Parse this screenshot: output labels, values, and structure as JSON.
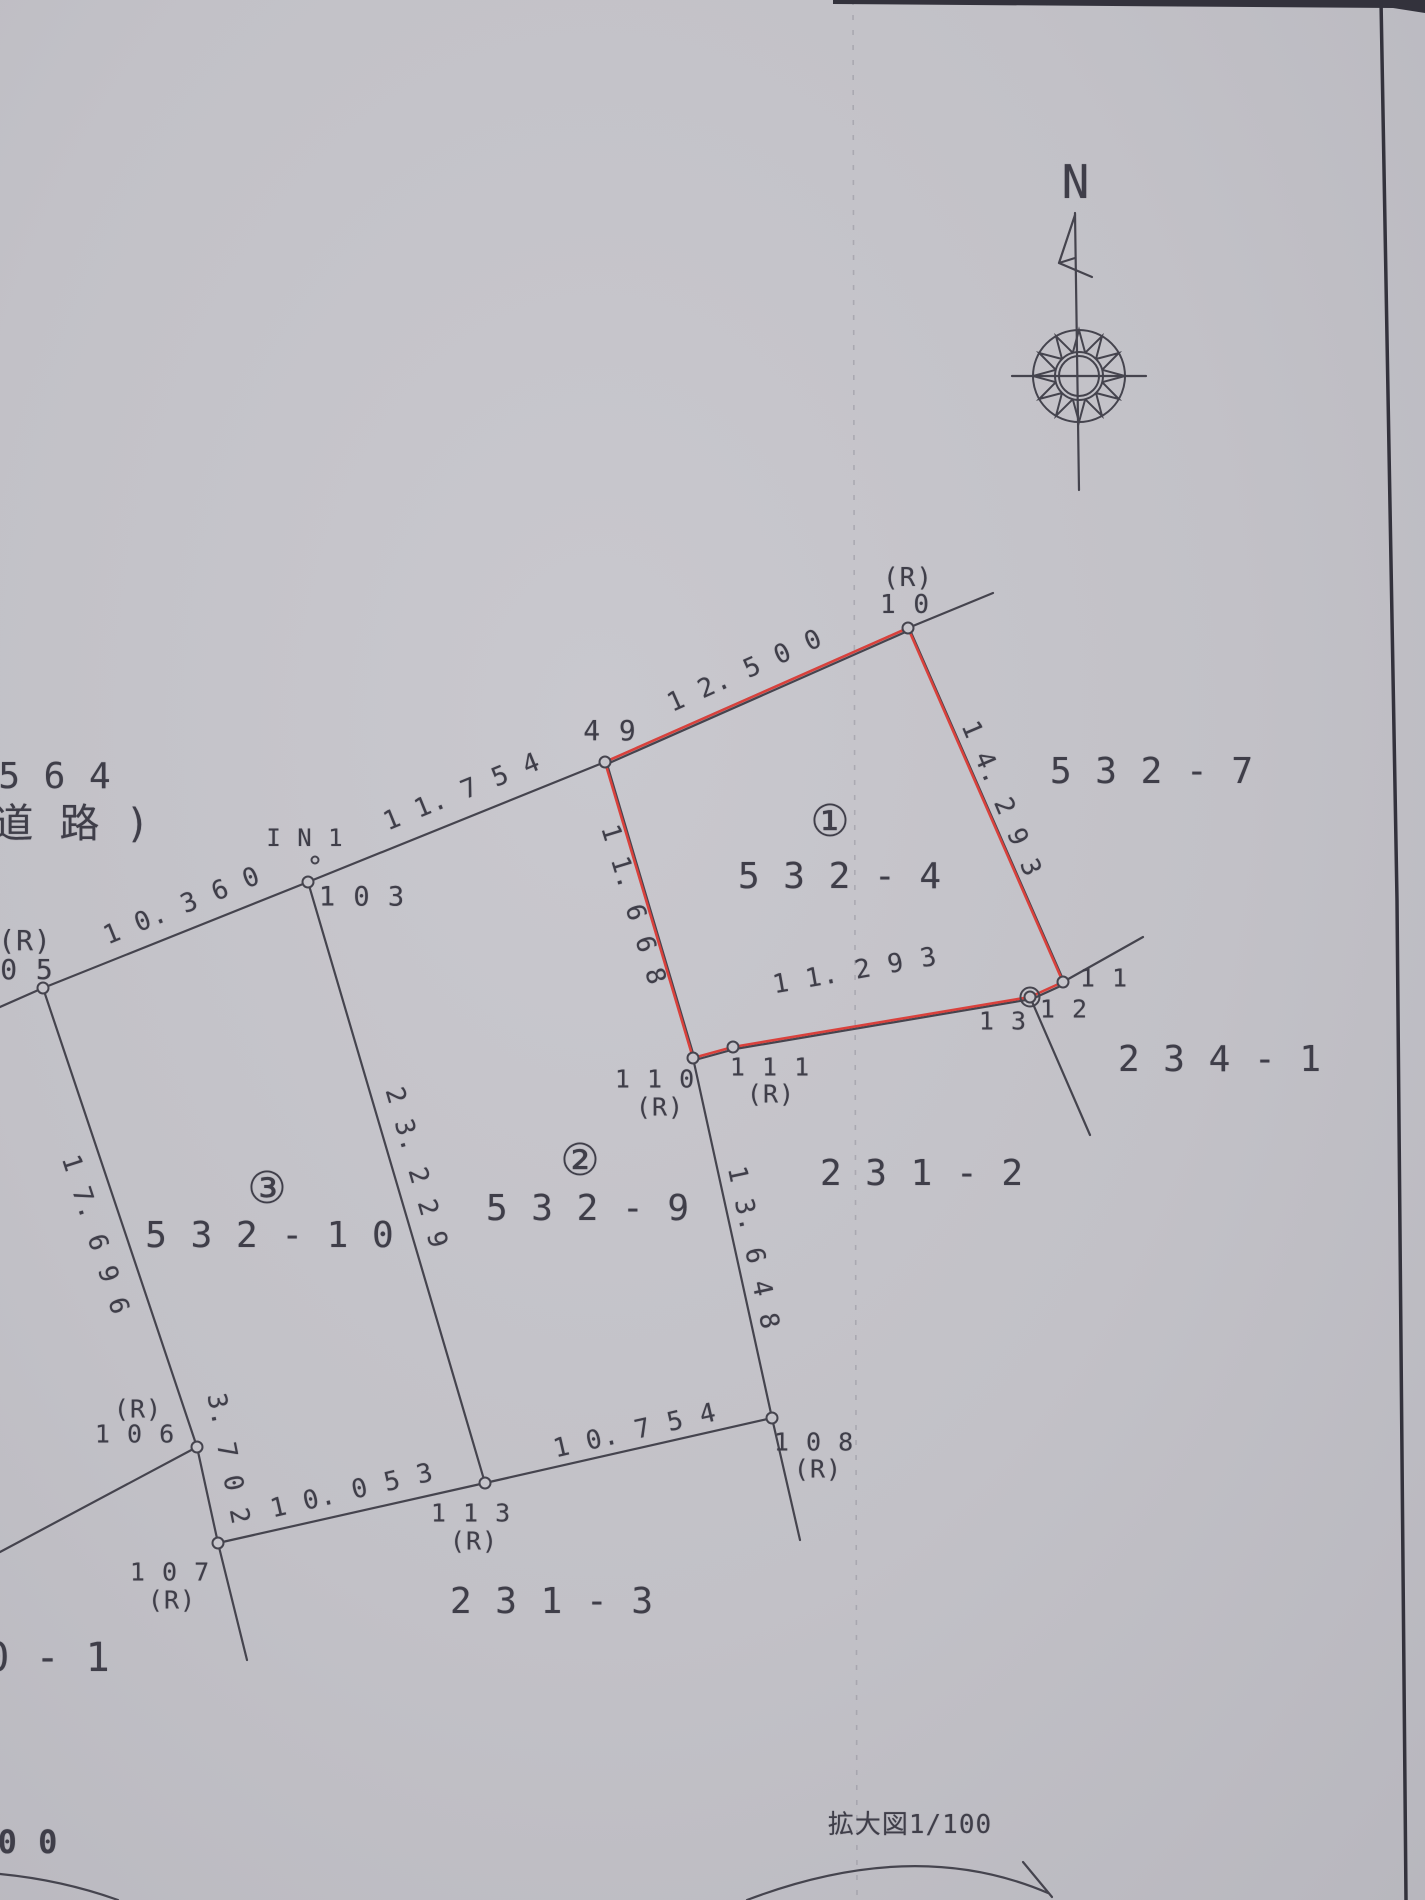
{
  "page": {
    "kind": "scanned cadastral enlarged map",
    "scale_note": "拡大図1/100",
    "north_label": "N"
  },
  "colors": {
    "paper": "#c2c1c7",
    "ink": "#45444e",
    "text": "#3f3e49",
    "red_boundary": "#d9413c",
    "page_edge": "#33323c"
  },
  "labels": [
    {
      "name": "parcel-564",
      "text": "5 6 4",
      "x": 55,
      "y": 777,
      "size": 36
    },
    {
      "name": "parcel-564-road",
      "text": "道 路 )",
      "x": 72,
      "y": 824,
      "size": 40
    },
    {
      "name": "point-05-r-label",
      "text": "(R)",
      "x": 25,
      "y": 941,
      "size": 28
    },
    {
      "name": "point-05-label",
      "text": "0 5",
      "x": 27,
      "y": 970,
      "size": 28
    },
    {
      "name": "len-10-360",
      "text": "1 0. 3 6 0",
      "x": 182,
      "y": 906,
      "size": 26,
      "rot": -22
    },
    {
      "name": "point-in1-label",
      "text": "I N 1",
      "x": 305,
      "y": 838,
      "size": 24
    },
    {
      "name": "point-103-label",
      "text": "1 0 3",
      "x": 362,
      "y": 897,
      "size": 27
    },
    {
      "name": "len-11-754",
      "text": "1 1. 7 5 4",
      "x": 462,
      "y": 792,
      "size": 26,
      "rot": -22
    },
    {
      "name": "point-49-label",
      "text": "4 9",
      "x": 610,
      "y": 731,
      "size": 28
    },
    {
      "name": "len-12-500",
      "text": "1 2. 5 0 0",
      "x": 745,
      "y": 671,
      "size": 26,
      "rot": -24
    },
    {
      "name": "point-10-r-label",
      "text": "(R)",
      "x": 908,
      "y": 578,
      "size": 26
    },
    {
      "name": "point-10-label",
      "text": "1 0",
      "x": 905,
      "y": 605,
      "size": 26
    },
    {
      "name": "parcel-532-7",
      "text": "5 3 2 - 7",
      "x": 1152,
      "y": 772,
      "size": 36
    },
    {
      "name": "parcel-1-mark",
      "text": "①",
      "x": 830,
      "y": 822,
      "size": 44,
      "cls": "circled"
    },
    {
      "name": "parcel-532-4",
      "text": "5 3 2 - 4",
      "x": 840,
      "y": 877,
      "size": 36
    },
    {
      "name": "len-14-293",
      "text": "1 4. 2 9 3",
      "x": 1001,
      "y": 799,
      "size": 26,
      "rot": 67
    },
    {
      "name": "len-11-668",
      "text": "1 1. 6 6 8",
      "x": 633,
      "y": 905,
      "size": 26,
      "rot": 73
    },
    {
      "name": "len-11-293",
      "text": "1 1. 2 9 3",
      "x": 855,
      "y": 971,
      "size": 26,
      "rot": -10
    },
    {
      "name": "point-11-label",
      "text": "1 1",
      "x": 1104,
      "y": 978,
      "size": 25
    },
    {
      "name": "point-12-label",
      "text": "1 2",
      "x": 1064,
      "y": 1009,
      "size": 25
    },
    {
      "name": "point-13-label",
      "text": "1 3",
      "x": 1003,
      "y": 1021,
      "size": 25
    },
    {
      "name": "parcel-234-1",
      "text": "2 3 4 - 1",
      "x": 1220,
      "y": 1060,
      "size": 36
    },
    {
      "name": "point-110-label",
      "text": "1 1 0",
      "x": 655,
      "y": 1079,
      "size": 25
    },
    {
      "name": "point-110-r-label",
      "text": "(R)",
      "x": 660,
      "y": 1107,
      "size": 25
    },
    {
      "name": "point-111-label",
      "text": "1 1 1",
      "x": 770,
      "y": 1067,
      "size": 25
    },
    {
      "name": "point-111-r-label",
      "text": "(R)",
      "x": 771,
      "y": 1094,
      "size": 25
    },
    {
      "name": "parcel-2-mark",
      "text": "②",
      "x": 580,
      "y": 1161,
      "size": 44,
      "cls": "circled"
    },
    {
      "name": "parcel-532-9",
      "text": "5 3 2 - 9",
      "x": 588,
      "y": 1209,
      "size": 36
    },
    {
      "name": "parcel-231-2",
      "text": "2 3 1 - 2",
      "x": 922,
      "y": 1174,
      "size": 36
    },
    {
      "name": "parcel-3-mark",
      "text": "③",
      "x": 267,
      "y": 1189,
      "size": 44,
      "cls": "circled"
    },
    {
      "name": "parcel-532-10",
      "text": "5 3 2 - 1 0",
      "x": 270,
      "y": 1236,
      "size": 36
    },
    {
      "name": "len-17-696",
      "text": "1 7. 6 9 6",
      "x": 95,
      "y": 1235,
      "size": 26,
      "rot": 72
    },
    {
      "name": "len-23-229",
      "text": "2 3. 2 2 9",
      "x": 416,
      "y": 1168,
      "size": 26,
      "rot": 74
    },
    {
      "name": "len-13-648",
      "text": "1 3. 6 4 8",
      "x": 753,
      "y": 1248,
      "size": 26,
      "rot": 78
    },
    {
      "name": "point-106-r-label",
      "text": "(R)",
      "x": 138,
      "y": 1409,
      "size": 25
    },
    {
      "name": "point-106-label",
      "text": "1 0 6",
      "x": 135,
      "y": 1434,
      "size": 25
    },
    {
      "name": "len-3-702",
      "text": "3. 7 0 2",
      "x": 228,
      "y": 1459,
      "size": 26,
      "rot": 79
    },
    {
      "name": "point-107-label",
      "text": "1 0 7",
      "x": 170,
      "y": 1572,
      "size": 25
    },
    {
      "name": "point-107-r-label",
      "text": "(R)",
      "x": 172,
      "y": 1600,
      "size": 25
    },
    {
      "name": "len-10-053",
      "text": "1 0. 0 5 3",
      "x": 352,
      "y": 1491,
      "size": 26,
      "rot": -13
    },
    {
      "name": "point-113-label",
      "text": "1 1 3",
      "x": 471,
      "y": 1513,
      "size": 25
    },
    {
      "name": "point-113-r-label",
      "text": "(R)",
      "x": 474,
      "y": 1541,
      "size": 25
    },
    {
      "name": "len-10-754",
      "text": "1 0. 7 5 4",
      "x": 635,
      "y": 1431,
      "size": 26,
      "rot": -13
    },
    {
      "name": "point-108-label",
      "text": "1 0 8",
      "x": 814,
      "y": 1442,
      "size": 25
    },
    {
      "name": "point-108-r-label",
      "text": "(R)",
      "x": 818,
      "y": 1469,
      "size": 25
    },
    {
      "name": "parcel-231-3",
      "text": "2 3 1 - 3",
      "x": 552,
      "y": 1602,
      "size": 36
    },
    {
      "name": "parcel-0-1",
      "text": "0 - 1",
      "x": 48,
      "y": 1658,
      "size": 40
    },
    {
      "name": "bottom-00",
      "text": "0 0",
      "x": 28,
      "y": 1842,
      "size": 32,
      "cls": "heavy"
    },
    {
      "name": "scale-note",
      "text": "拡大図1/100",
      "x": 910,
      "y": 1825,
      "size": 26
    },
    {
      "name": "north-n-label",
      "text": "N",
      "x": 1076,
      "y": 182,
      "size": 46
    }
  ],
  "geometry": {
    "red_boundary": {
      "name": "highlighted-parcel-532-4-boundary",
      "pts": [
        [
          605,
          762
        ],
        [
          908,
          628
        ],
        [
          1063,
          982
        ],
        [
          1030,
          997
        ],
        [
          733,
          1047
        ],
        [
          693,
          1058
        ]
      ]
    },
    "lines": [
      {
        "name": "road-boundary-line",
        "pts": [
          [
            0,
            1007
          ],
          [
            43,
            988
          ],
          [
            308,
            882
          ],
          [
            605,
            762
          ],
          [
            908,
            628
          ],
          [
            993,
            593
          ]
        ]
      },
      {
        "name": "line-ext-point-11",
        "pts": [
          [
            1063,
            982
          ],
          [
            1143,
            937
          ]
        ]
      },
      {
        "name": "line-12-down",
        "pts": [
          [
            1030,
            997
          ],
          [
            1090,
            1135
          ]
        ]
      },
      {
        "name": "line-23-229",
        "pts": [
          [
            308,
            882
          ],
          [
            485,
            1483
          ]
        ]
      },
      {
        "name": "line-17-696",
        "pts": [
          [
            43,
            988
          ],
          [
            197,
            1447
          ]
        ]
      },
      {
        "name": "line-106-left",
        "pts": [
          [
            197,
            1447
          ],
          [
            0,
            1552
          ]
        ]
      },
      {
        "name": "line-3-702",
        "pts": [
          [
            197,
            1447
          ],
          [
            218,
            1543
          ]
        ]
      },
      {
        "name": "line-107-down",
        "pts": [
          [
            218,
            1543
          ],
          [
            247,
            1660
          ]
        ]
      },
      {
        "name": "line-10-053",
        "pts": [
          [
            218,
            1543
          ],
          [
            485,
            1483
          ]
        ]
      },
      {
        "name": "line-10-754",
        "pts": [
          [
            485,
            1483
          ],
          [
            772,
            1418
          ]
        ]
      },
      {
        "name": "line-13-648",
        "pts": [
          [
            693,
            1058
          ],
          [
            772,
            1418
          ]
        ]
      },
      {
        "name": "line-108-down",
        "pts": [
          [
            772,
            1418
          ],
          [
            800,
            1540
          ]
        ]
      },
      {
        "name": "compass-horizontal",
        "pts": [
          [
            1012,
            376
          ],
          [
            1146,
            376
          ]
        ]
      },
      {
        "name": "compass-vertical",
        "pts": [
          [
            1075,
            213
          ],
          [
            1079,
            490
          ]
        ]
      },
      {
        "name": "north-flag",
        "pts": [
          [
            1075,
            215
          ],
          [
            1059,
            263
          ],
          [
            1075,
            258
          ]
        ]
      },
      {
        "name": "north-flag-tail",
        "pts": [
          [
            1059,
            263
          ],
          [
            1092,
            277
          ]
        ]
      }
    ],
    "points": [
      {
        "name": "point-05",
        "x": 43,
        "y": 988
      },
      {
        "name": "point-103-junction",
        "x": 308,
        "y": 882
      },
      {
        "name": "point-in1",
        "x": 315,
        "y": 860,
        "r": 3.5
      },
      {
        "name": "point-49",
        "x": 605,
        "y": 762
      },
      {
        "name": "point-10",
        "x": 908,
        "y": 628
      },
      {
        "name": "point-11",
        "x": 1063,
        "y": 982
      },
      {
        "name": "point-12-13",
        "x": 1030,
        "y": 997,
        "double": true
      },
      {
        "name": "point-110",
        "x": 693,
        "y": 1058
      },
      {
        "name": "point-111",
        "x": 733,
        "y": 1047
      },
      {
        "name": "point-106",
        "x": 197,
        "y": 1447
      },
      {
        "name": "point-107",
        "x": 218,
        "y": 1543
      },
      {
        "name": "point-113",
        "x": 485,
        "y": 1483
      },
      {
        "name": "point-108",
        "x": 772,
        "y": 1418
      }
    ],
    "arcs": [
      {
        "name": "bottom-left-arc",
        "d": "M 0 1874 Q 62 1880 118 1900"
      },
      {
        "name": "bottom-center-arc",
        "d": "M 747 1900 Q 915 1836 1048 1893"
      },
      {
        "name": "bottom-arc-line",
        "d": "M 1023 1862 L 1052 1897"
      }
    ],
    "fold_line": {
      "x1": 853,
      "y1": 0,
      "x2": 857,
      "y2": 1900
    },
    "page_edge": {
      "strip": "833,0 1425,0 1425,13 1393,8 833,4",
      "line": [
        [
          1381,
          0
        ],
        [
          1397,
          900
        ],
        [
          1406,
          1900
        ]
      ]
    },
    "compass": {
      "cx": 1079,
      "cy": 376,
      "r_outer": 46,
      "r_inner": 24,
      "r_inner2": 20,
      "star_points": 12
    }
  }
}
